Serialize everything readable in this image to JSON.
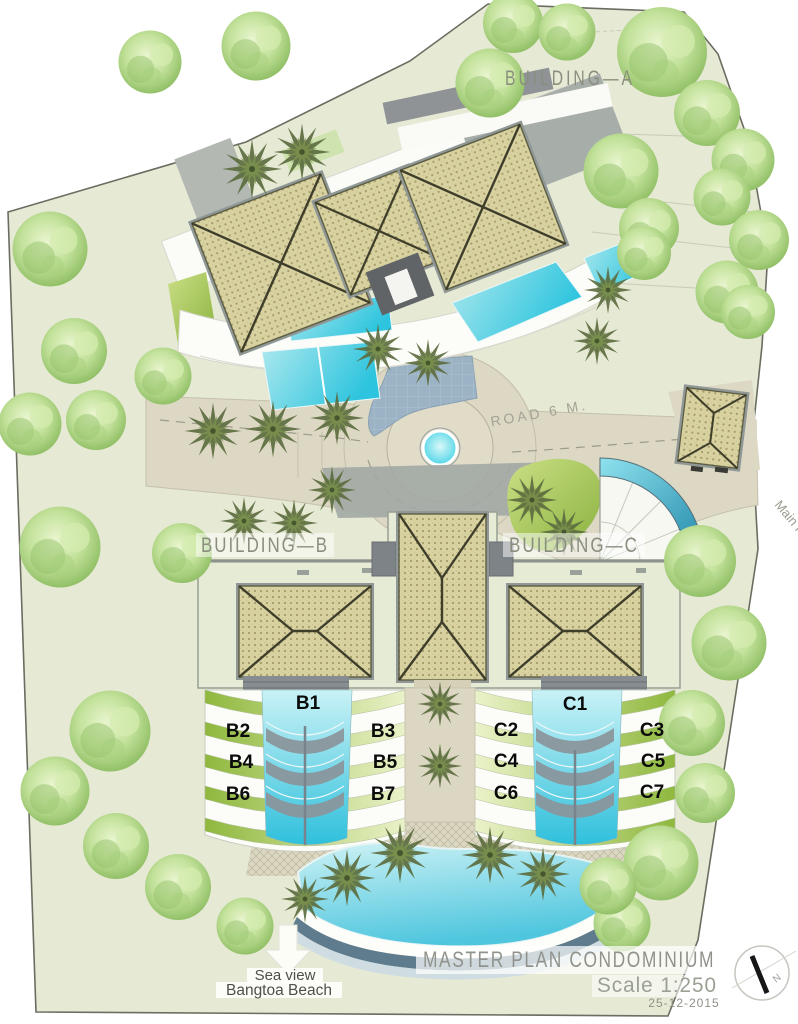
{
  "drawing": {
    "building_a": "BUILDING—A",
    "building_b": "BUILDING—B",
    "building_c": "BUILDING—C",
    "road": "ROAD 6 M.",
    "main_road": "Main R",
    "north": "N",
    "sea_view_line1": "Sea view",
    "sea_view_line2": "Bangtoa Beach",
    "title": "MASTER PLAN CONDOMINIUM",
    "scale": "Scale 1:250",
    "date": "25-12-2015",
    "units_b": [
      "B1",
      "B2",
      "B3",
      "B4",
      "B5",
      "B6",
      "B7"
    ],
    "units_c": [
      "C1",
      "C2",
      "C3",
      "C4",
      "C5",
      "C6",
      "C7"
    ],
    "colors": {
      "site_green": "#e7ead6",
      "water_cyan": "#3fc8e0",
      "roof_tan": "#d8d1a0",
      "stripe_green": "#9cc24c",
      "road_beige": "#dcd8c4",
      "label_gray": "#8f938b"
    }
  }
}
